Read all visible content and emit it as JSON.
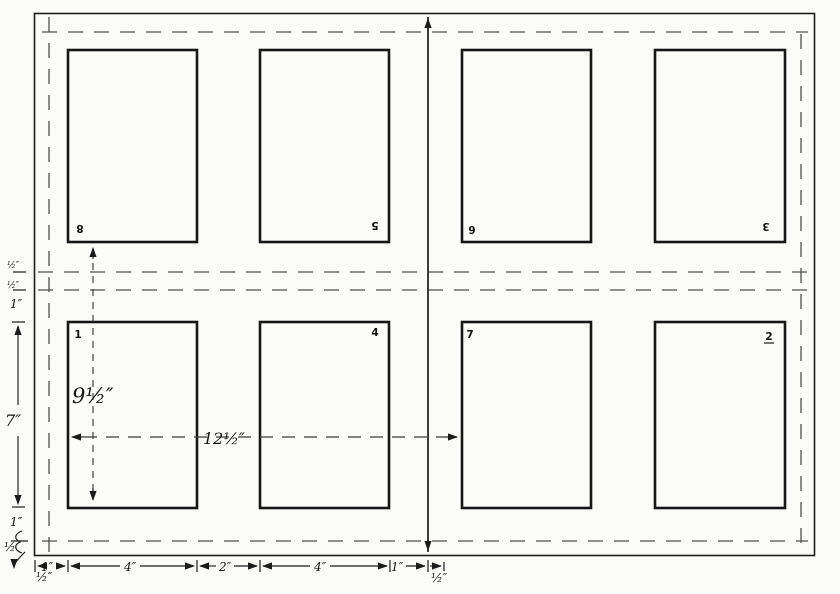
{
  "title": "Hand-drawn sheet imposition diagram, eight-page form",
  "colors": {
    "ink": "#1c1c1c",
    "paper": "#fbfbf8",
    "dash_gray": "#4f4f4f"
  },
  "pages": {
    "top_row_numbers": [
      "8",
      "5",
      "6",
      "3"
    ],
    "bottom_row_numbers": [
      "1",
      "4",
      "7",
      "2"
    ]
  },
  "dimensions": {
    "page_column_height": "9½″",
    "half_sheet_width": "12½″",
    "bottom_chain": [
      "1″",
      "4″",
      "2″",
      "4″",
      "1″",
      "½″"
    ],
    "left_chain": {
      "upper_half_a": "½″",
      "upper_half_b": "½″",
      "upper_one": "1″",
      "page_height": "7″",
      "lower_one": "1″",
      "lower_half": "½",
      "corner_half": "½″"
    }
  }
}
